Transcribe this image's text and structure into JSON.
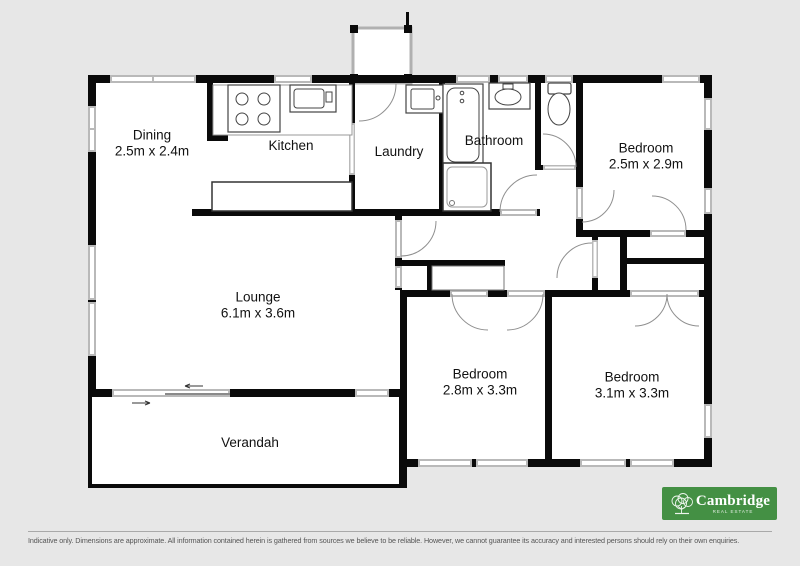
{
  "plan": {
    "rooms": {
      "dining": {
        "name": "Dining",
        "dims": "2.5m x 2.4m"
      },
      "kitchen": {
        "name": "Kitchen"
      },
      "laundry": {
        "name": "Laundry"
      },
      "bathroom": {
        "name": "Bathroom"
      },
      "bedroom_tr": {
        "name": "Bedroom",
        "dims": "2.5m x 2.9m"
      },
      "lounge": {
        "name": "Lounge",
        "dims": "6.1m x 3.6m"
      },
      "bedroom_bl": {
        "name": "Bedroom",
        "dims": "2.8m x 3.3m"
      },
      "bedroom_br": {
        "name": "Bedroom",
        "dims": "3.1m x 3.3m"
      },
      "verandah": {
        "name": "Verandah"
      }
    }
  },
  "branding": {
    "agency_name": "Cambridge",
    "agency_tagline": "Real Estate",
    "brand_color": "#449044"
  },
  "footer": {
    "disclaimer": "Indicative only. Dimensions are approximate. All information contained herein is gathered from sources we believe to be reliable. However, we cannot guarantee its accuracy and interested persons should rely on their own enquiries."
  }
}
